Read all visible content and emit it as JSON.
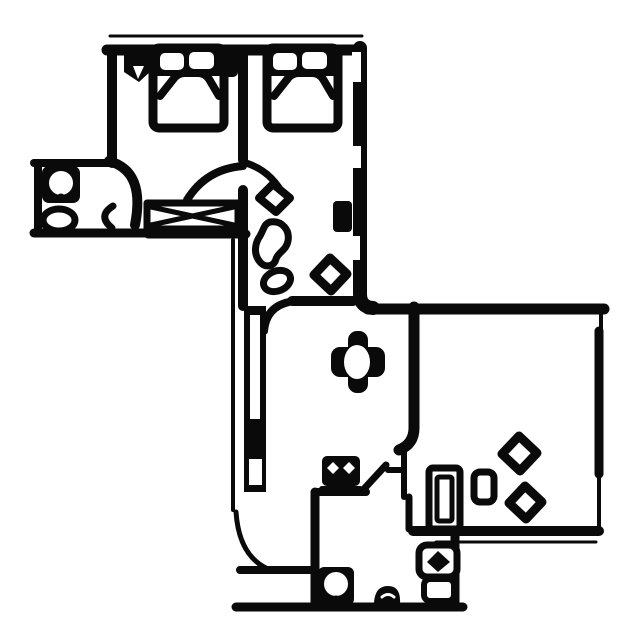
{
  "meta": {
    "title": "Black-and-white apartment floor plan drawing",
    "diagram_type": "floor-plan",
    "text_labels": []
  },
  "palette": {
    "background": "#ffffff",
    "ink": "#0a0a0a"
  },
  "rooms": [
    {
      "id": "bedroom-1",
      "semantic": "upper-left bedroom with double bed"
    },
    {
      "id": "bedroom-2",
      "semantic": "upper-right bedroom with double bed"
    },
    {
      "id": "bathroom-upper",
      "semantic": "small bathroom annex upper-left with toilet and sink"
    },
    {
      "id": "hallway",
      "semantic": "vertical hallway connecting upper and lower sections"
    },
    {
      "id": "living-room",
      "semantic": "central living/dining room with table"
    },
    {
      "id": "room-right",
      "semantic": "large room lower-right with seats"
    },
    {
      "id": "bathroom-lower",
      "semantic": "lower bathroom/WC with toilet and washbasin"
    },
    {
      "id": "entry",
      "semantic": "entrance door lower-left with swing arc"
    }
  ],
  "symbols": [
    {
      "id": "double-bed-1-icon",
      "semantic": "double bed with two pillows against top wall"
    },
    {
      "id": "double-bed-2-icon",
      "semantic": "double bed with two pillows against top wall"
    },
    {
      "id": "toilet-upper-icon",
      "semantic": "toilet seen from above"
    },
    {
      "id": "sink-upper-icon",
      "semantic": "oval wash basin"
    },
    {
      "id": "wardrobe-x-icon",
      "semantic": "crossed rectangle wardrobe/closet"
    },
    {
      "id": "door-arc-icon",
      "semantic": "quarter-circle door swing"
    },
    {
      "id": "dining-table-icon",
      "semantic": "oval table with four chairs forming a cross"
    },
    {
      "id": "stove-icon",
      "semantic": "appliance block with two burners"
    },
    {
      "id": "plant-bean-icon",
      "semantic": "bean-shaped decor blob in hallway"
    },
    {
      "id": "stool-diamond-icon",
      "semantic": "rotated-square seat"
    },
    {
      "id": "radiator-icon",
      "semantic": "tall double rectangle by doorway"
    },
    {
      "id": "toilet-lower-icon",
      "semantic": "toilet seen from above"
    },
    {
      "id": "washbasin-lower-icon",
      "semantic": "basin with diamond bowl"
    },
    {
      "id": "floor-blob-icon",
      "semantic": "small half-round object on bottom wall"
    }
  ]
}
